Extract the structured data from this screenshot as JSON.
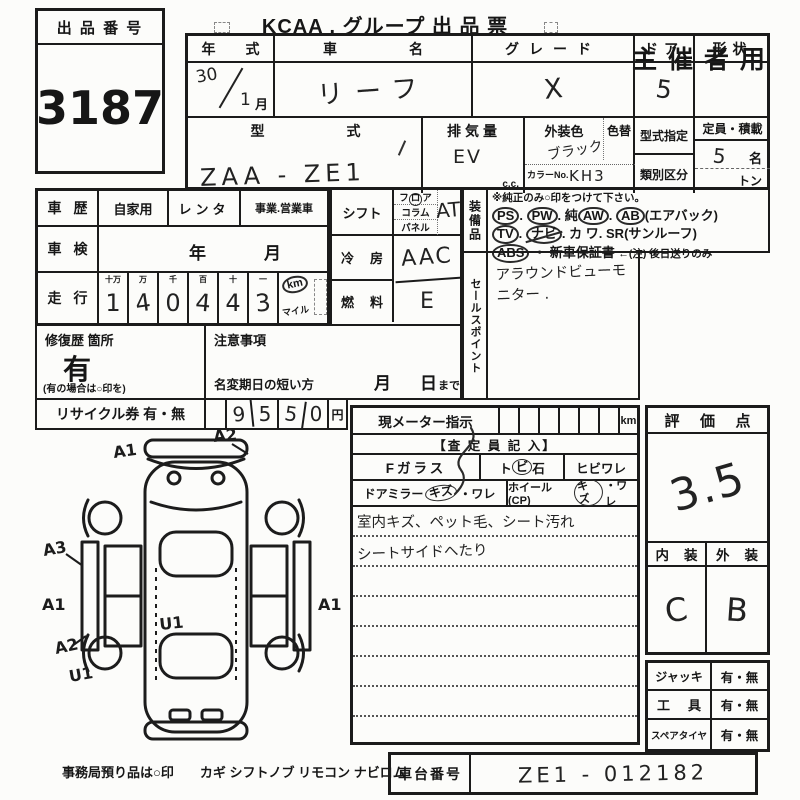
{
  "header": {
    "lot_label": "出 品 番 号",
    "lot_number": "3187",
    "title": "KCAA . グループ 出 品 票",
    "audience": "主 催 者 用"
  },
  "top": {
    "year_label": "年式",
    "year": "30",
    "month": "1",
    "month_unit": "月",
    "name_label": "車名",
    "name": "リーフ",
    "grade_label": "グレード",
    "grade": "X",
    "door_label": "ドア",
    "doors": "5",
    "shape_label": "形状",
    "model_label": "型式",
    "model": "ZAA - ZE1",
    "disp_label": "排気量",
    "disp": "EV",
    "disp_unit": "c.c.",
    "color_label": "外装色",
    "color": "ブラック",
    "color_no_label": "カラーNo.",
    "color_no": "KH3",
    "color_change_label": "色替",
    "type_desig_label": "型式指定",
    "class_label": "類別区分",
    "capacity_label": "定員・積載",
    "capacity": "5",
    "capacity_unit": "名",
    "load_unit": "トン"
  },
  "history": {
    "label": "車歴",
    "use1": "自家用",
    "use2": "レンタ",
    "use3": "事業.営業車",
    "inspection_label": "車検",
    "inspection_year": "年",
    "inspection_month": "月",
    "mileage_label": "走行",
    "digit_headers": [
      "十万",
      "万",
      "千",
      "百",
      "十",
      "一"
    ],
    "digits": [
      "1",
      "4",
      "0",
      "4",
      "4",
      "3"
    ],
    "unit_km": "km",
    "unit_mile": "マイル",
    "repair_label": "修復歴 箇所",
    "repair_value": "有",
    "repair_note": "(有の場合は○印を)",
    "caution_label": "注意事項",
    "rename_label": "名変期日の短い方",
    "rename_month": "月",
    "rename_day": "日",
    "rename_suffix": "まで",
    "recycle_label": "リサイクル券 有・無",
    "recycle_digits": [
      "9",
      "5",
      "5",
      "0"
    ],
    "recycle_unit": "円"
  },
  "specs": {
    "shift_label": "シフト",
    "shift_f1": "フ",
    "shift_f2": "ロ",
    "shift_f3": "ア",
    "shift_opt2": "コラム",
    "shift_opt3": "パネル",
    "shift_value": "AT",
    "ac_label": "冷房",
    "ac_value": "AAC",
    "fuel_label": "燃料",
    "fuel_value": "E"
  },
  "equipment": {
    "label": "装備品",
    "note": "※純正のみ○印をつけて下さい。",
    "dot": ".",
    "r1_i1": "PS",
    "r1_i2": "PW",
    "r1_i3pre": "純",
    "r1_i3": "AW",
    "r1_i4": "AB",
    "r1_i4suf": "(エアバック)",
    "r2_i1": "TV",
    "r2_i2": "ナビ",
    "r2_i3": "カ ワ",
    "r2_i4": "SR",
    "r2_i4suf": "(サンルーフ)",
    "r3_i1": "ABS",
    "r3_sep": "・",
    "r3_i2": "新車保証書",
    "r3_note": "←(注) 後日送りのみ"
  },
  "sales": {
    "label": "セールスポイント",
    "text": "アラウンドビューモニター ."
  },
  "meter": {
    "label": "現メーター指示",
    "unit": "km",
    "assessor": "【査 定 員 記 入】",
    "fglass_label": "Fガラス",
    "opt1_pre": "ト",
    "opt1_circ": "ビ",
    "opt1_post": "石",
    "opt2": "ヒビワレ",
    "mirror_label": "ドアミラー",
    "mirror_circ": "キズ",
    "mirror_rest": "・ワレ",
    "wheel_label": "ホイール(CP)",
    "wheel_circ": "キズ",
    "wheel_rest": "・ワレ",
    "note1": "室内キズ、ペット毛、シート汚れ",
    "note2": "シートサイドへたり"
  },
  "evaluation": {
    "score_label": "評価点",
    "score": "3.5",
    "interior_label": "内装",
    "exterior_label": "外装",
    "interior": "C",
    "exterior": "B"
  },
  "accessories": {
    "jack_label": "ジャッキ",
    "jack": "有・無",
    "tool_label": "工具",
    "tool": "有・無",
    "spare_label": "スペアタイヤ",
    "spare": "有・無"
  },
  "footer": {
    "note": "事務局預り品は○印",
    "items": "カギ シフトノブ リモコン ナビロム",
    "chassis_label": "車台番号",
    "chassis": "ZE1 - 012182"
  },
  "diagram": {
    "marks": [
      {
        "label": "A1"
      },
      {
        "label": "A2"
      },
      {
        "label": "A3"
      },
      {
        "label": "A1"
      },
      {
        "label": "A2"
      },
      {
        "label": "U1"
      },
      {
        "label": "U1"
      },
      {
        "label": "A1"
      }
    ]
  }
}
